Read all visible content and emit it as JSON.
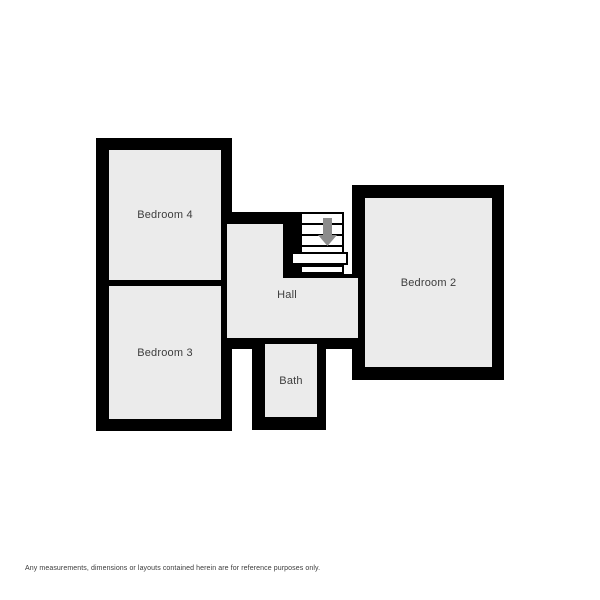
{
  "rooms": {
    "bedroom4": {
      "label": "Bedroom 4"
    },
    "bedroom3": {
      "label": "Bedroom 3"
    },
    "bedroom2": {
      "label": "Bedroom 2"
    },
    "hall": {
      "label": "Hall"
    },
    "bath": {
      "label": "Bath"
    }
  },
  "stairs": {
    "direction": "down",
    "step_count": 6
  },
  "colors": {
    "wall": "#000000",
    "room_fill": "#ebebeb",
    "stair_arrow": "#8c8c8c",
    "label_text": "#3d3d3d",
    "background": "#ffffff"
  },
  "footer": {
    "disclaimer": "Any measurements, dimensions or layouts contained herein are for reference purposes only."
  }
}
